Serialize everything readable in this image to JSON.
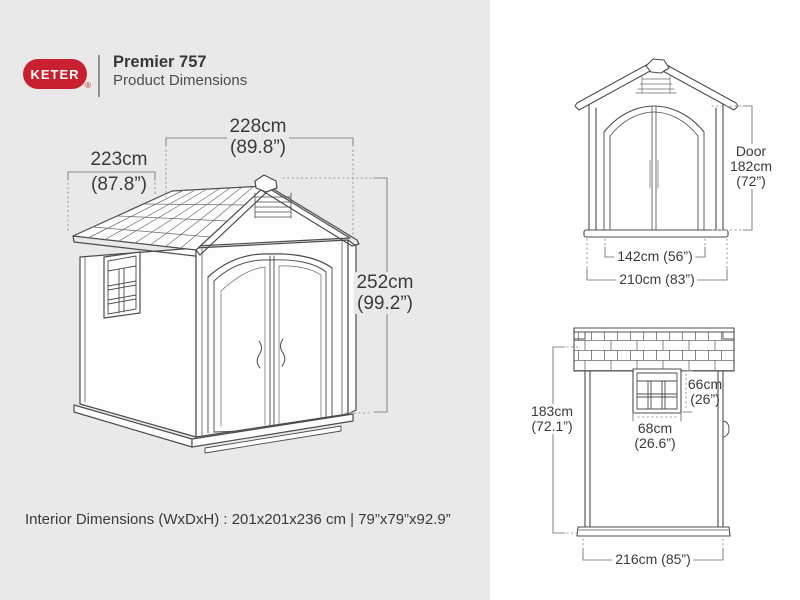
{
  "header": {
    "brand": "KETER",
    "registered_mark": "®",
    "product_name": "Premier 757",
    "subtitle": "Product Dimensions",
    "brand_color": "#c8202f"
  },
  "main_view": {
    "view_name": "3d-perspective-view",
    "width_cm": "228cm",
    "width_in": "(89.8”)",
    "depth_cm": "223cm",
    "depth_in": "(87.8”)",
    "height_cm": "252cm",
    "height_in": "(99.2”)"
  },
  "front_view": {
    "view_name": "front-elevation",
    "door_label": "Door",
    "door_height_cm": "182cm",
    "door_height_in": "(72”)",
    "door_width": "142cm (56”)",
    "overall_width": "210cm (83”)"
  },
  "side_view": {
    "view_name": "side-elevation",
    "height_cm": "183cm",
    "height_in": "(72.1”)",
    "window_height_cm": "66cm",
    "window_height_in": "(26”)",
    "window_width_cm": "68cm",
    "window_width_in": "(26.6”)",
    "overall_depth": "216cm (85”)"
  },
  "footer": {
    "interior_dimensions": "Interior Dimensions (WxDxH) : 201x201x236 cm | 79”x79”x92.9”"
  },
  "colors": {
    "panel_left_bg": "#e9e9e9",
    "panel_right_bg": "#ffffff",
    "drawing_line": "#4c4c4c",
    "dimension_line": "#8a8a8a",
    "text": "#3a3a3a",
    "brand_red": "#c8202f"
  }
}
